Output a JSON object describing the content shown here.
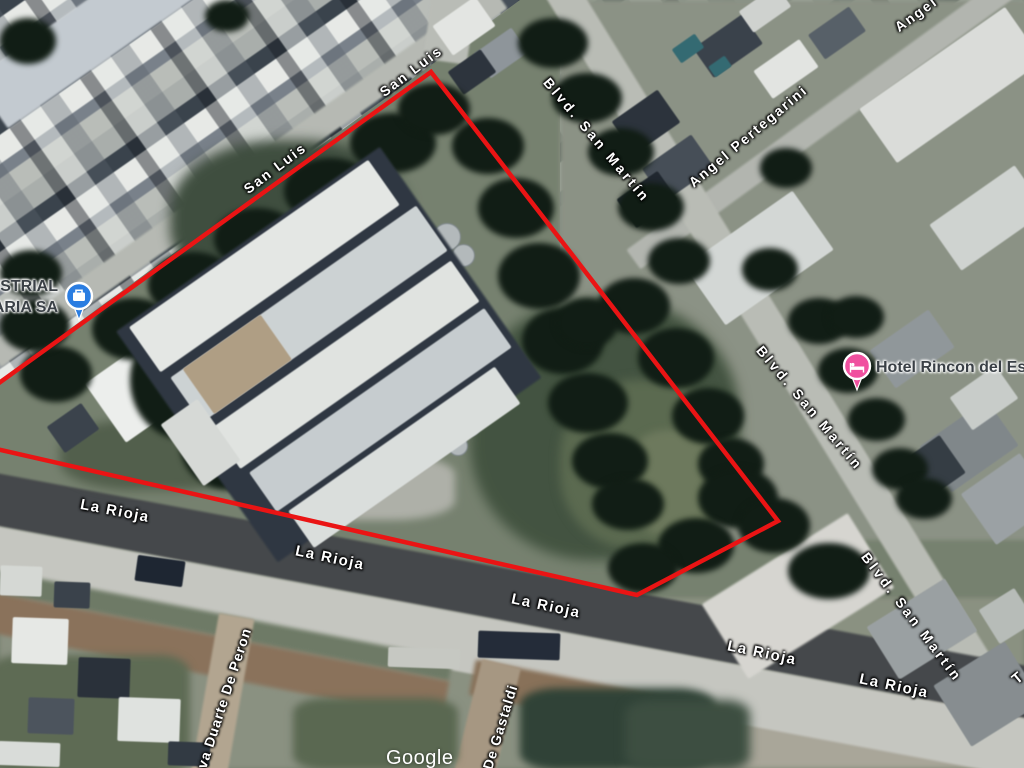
{
  "map": {
    "watermark": "Google",
    "boundary": {
      "color": "#ea1414",
      "stroke_width": 4.5,
      "points": "431,72 778,521 637,595 -8,448 -8,388"
    },
    "street_labels": [
      {
        "text": "San Luis",
        "x": 275,
        "y": 168,
        "rot": -37,
        "fs": 14,
        "ls": 2
      },
      {
        "text": "San Luis",
        "x": 411,
        "y": 71,
        "rot": -37,
        "fs": 14,
        "ls": 2
      },
      {
        "text": "Blvd. San Martín",
        "x": 597,
        "y": 140,
        "rot": 50,
        "fs": 14,
        "ls": 3
      },
      {
        "text": "Angel Pertegarini",
        "x": 748,
        "y": 136,
        "rot": -40,
        "fs": 14,
        "ls": 2
      },
      {
        "text": "Angel",
        "x": 916,
        "y": 14,
        "rot": -36,
        "fs": 14,
        "ls": 2
      },
      {
        "text": "Blvd. San Martín",
        "x": 810,
        "y": 408,
        "rot": 50,
        "fs": 14,
        "ls": 3
      },
      {
        "text": "Blvd. San Martín",
        "x": 912,
        "y": 617,
        "rot": 53,
        "fs": 14,
        "ls": 3
      },
      {
        "text": "La Rioja",
        "x": 115,
        "y": 511,
        "rot": 11,
        "fs": 15,
        "ls": 1.5
      },
      {
        "text": "La Rioja",
        "x": 330,
        "y": 558,
        "rot": 12,
        "fs": 15,
        "ls": 1.5
      },
      {
        "text": "La Rioja",
        "x": 546,
        "y": 606,
        "rot": 12,
        "fs": 15,
        "ls": 1.5
      },
      {
        "text": "La Rioja",
        "x": 762,
        "y": 653,
        "rot": 12,
        "fs": 15,
        "ls": 1.5
      },
      {
        "text": "La Rioja",
        "x": 894,
        "y": 686,
        "rot": 12,
        "fs": 15,
        "ls": 1.5
      },
      {
        "text": "va Duarte De Peron",
        "x": 224,
        "y": 698,
        "rot": -72,
        "fs": 14,
        "ls": 1
      },
      {
        "text": "De Gastaldi",
        "x": 500,
        "y": 727,
        "rot": -73,
        "fs": 14,
        "ls": 1
      },
      {
        "text": "T",
        "x": 1018,
        "y": 678,
        "rot": -40,
        "fs": 15,
        "ls": 1
      }
    ],
    "poi_industrial": {
      "line1": "USTRIAL",
      "line2": "ARIA SA",
      "icon": "briefcase-pin-icon",
      "pin_color": "#2a7de1"
    },
    "poi_hotel": {
      "label": "Hotel Rincon del Este",
      "icon": "bed-pin-icon",
      "pin_color": "#f0509f"
    }
  }
}
